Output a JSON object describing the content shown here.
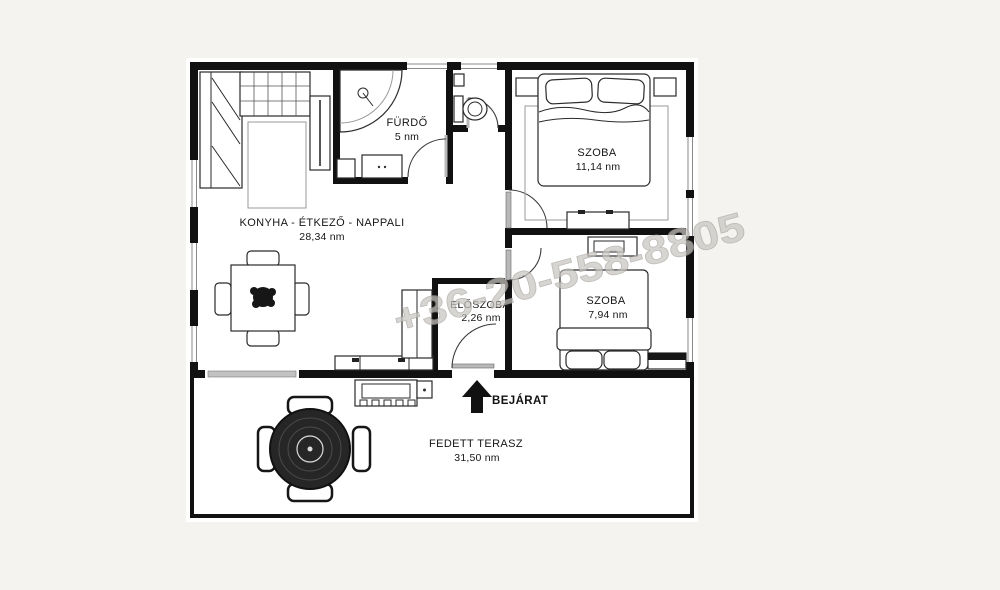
{
  "document": {
    "kind": "floor-plan"
  },
  "watermark": {
    "text": "+36-20-558-8805",
    "color": "#c9c6c2"
  },
  "rooms": {
    "kitchen": {
      "name": "KONYHA - ÉTKEZŐ - NAPPALI",
      "area": "28,34 nm"
    },
    "bathroom": {
      "name": "FÜRDŐ",
      "area": "5 nm"
    },
    "bedroom1": {
      "name": "SZOBA",
      "area": "11,14 nm"
    },
    "hallway": {
      "name": "ELŐSZOBA",
      "area": "2,26 nm"
    },
    "bedroom2": {
      "name": "SZOBA",
      "area": "7,94 nm"
    },
    "terrace": {
      "name": "FEDETT TERASZ",
      "area": "31,50 nm"
    }
  },
  "entrance": {
    "label": "BEJÁRAT"
  },
  "colors": {
    "wall": "#111111",
    "background": "#f4f3ef",
    "paper": "#ffffff",
    "watermark": "#c9c6c2"
  }
}
